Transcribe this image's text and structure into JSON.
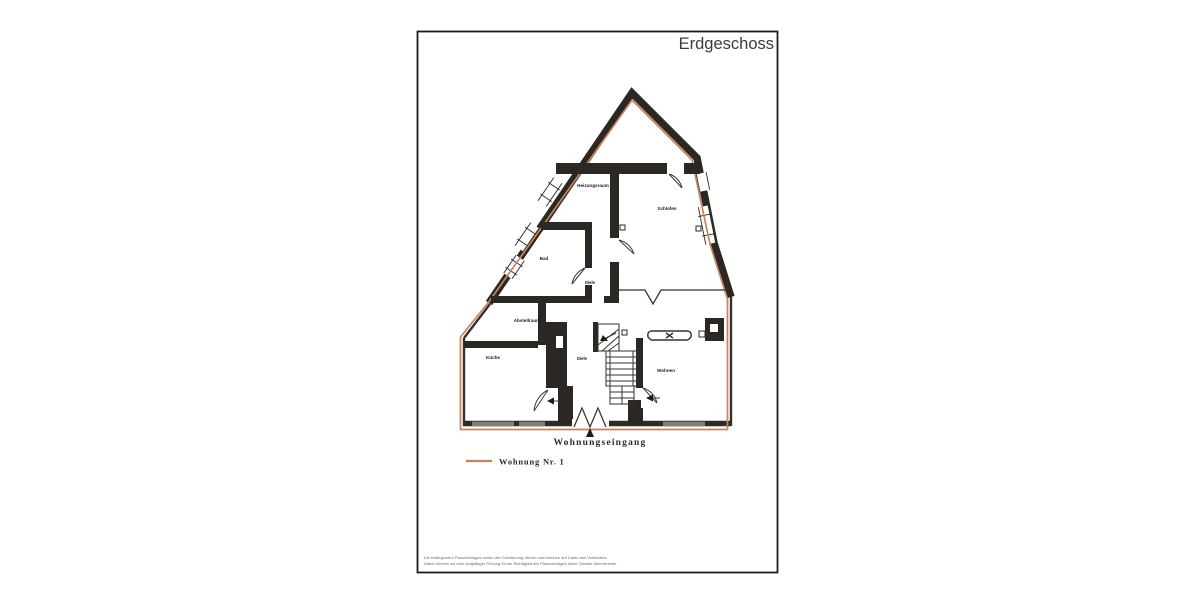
{
  "page": {
    "title": "Erdgeschoss",
    "background": "#ffffff",
    "border_color": "#1b1b1b"
  },
  "plan": {
    "wall_color": "#2b2823",
    "boundary_color": "#c9825c",
    "rooms": [
      {
        "label": "Heizungsraum"
      },
      {
        "label": "Schlafen"
      },
      {
        "label": "Bad"
      },
      {
        "label": "Diele"
      },
      {
        "label": "Abstellraum"
      },
      {
        "label": "Küche"
      },
      {
        "label": "Diele"
      },
      {
        "label": "Wohnen"
      }
    ],
    "entrance_label": "Wohnungseingang"
  },
  "legend": {
    "line_color": "#c9825c",
    "label": "Wohnung Nr. 1"
  },
  "disclaimer": {
    "line1": "Die beiliegenden Planunterlagen sollen der Orientierung dienen und beruhen auf Daten des Verkäufers.",
    "line2": "Daher können wir trotz sorgfältiger Prüfung für die Richtigkeit der Planunterlagen keine Gewähr übernehmen"
  }
}
